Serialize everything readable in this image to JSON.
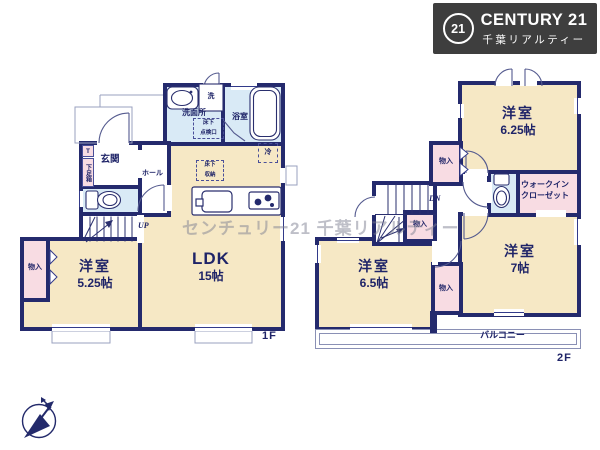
{
  "colors": {
    "wall_navy": "#242a6d",
    "room_beige": "#f6e8c5",
    "closet_pink": "#f8dce3",
    "wet_area_blue": "#d9eaf6",
    "thin_line": "#323a8a",
    "porch_line": "#9aa0bf",
    "logo_background": "#3e3e3e",
    "watermark_gray": "#7d8091"
  },
  "logo": {
    "circle": "21",
    "brand": "CENTURY 21",
    "company": "千葉リアルティー"
  },
  "watermark_text": "センチュリー21 千葉リアルティー",
  "floor1": {
    "floor_label": "1F",
    "ldk": {
      "name": "LDK",
      "area": "15帖"
    },
    "bedroom": {
      "name": "洋室",
      "area": "5.25帖"
    },
    "entrance": "玄関",
    "hall": "ホール",
    "washroom": "洗面所",
    "bathroom": "浴室",
    "laundry": "洗",
    "closet": "物入",
    "shoe_t": "T",
    "shoe_box": "下足箱",
    "fridge": "冷",
    "stairs_up": "UP",
    "underfloor_storage": {
      "line1": "床下",
      "line2": "収納"
    },
    "inspection_hatch": {
      "line1": "床下",
      "line2": "点検口"
    }
  },
  "floor2": {
    "floor_label": "2F",
    "bedroom_625": {
      "name": "洋室",
      "area": "6.25帖"
    },
    "bedroom_65": {
      "name": "洋室",
      "area": "6.5帖"
    },
    "bedroom_7": {
      "name": "洋室",
      "area": "7帖"
    },
    "wic": {
      "line1": "ウォークイン",
      "line2": "クローゼット"
    },
    "closet": "物入",
    "balcony": "バルコニー",
    "stairs_dn": "DN"
  }
}
